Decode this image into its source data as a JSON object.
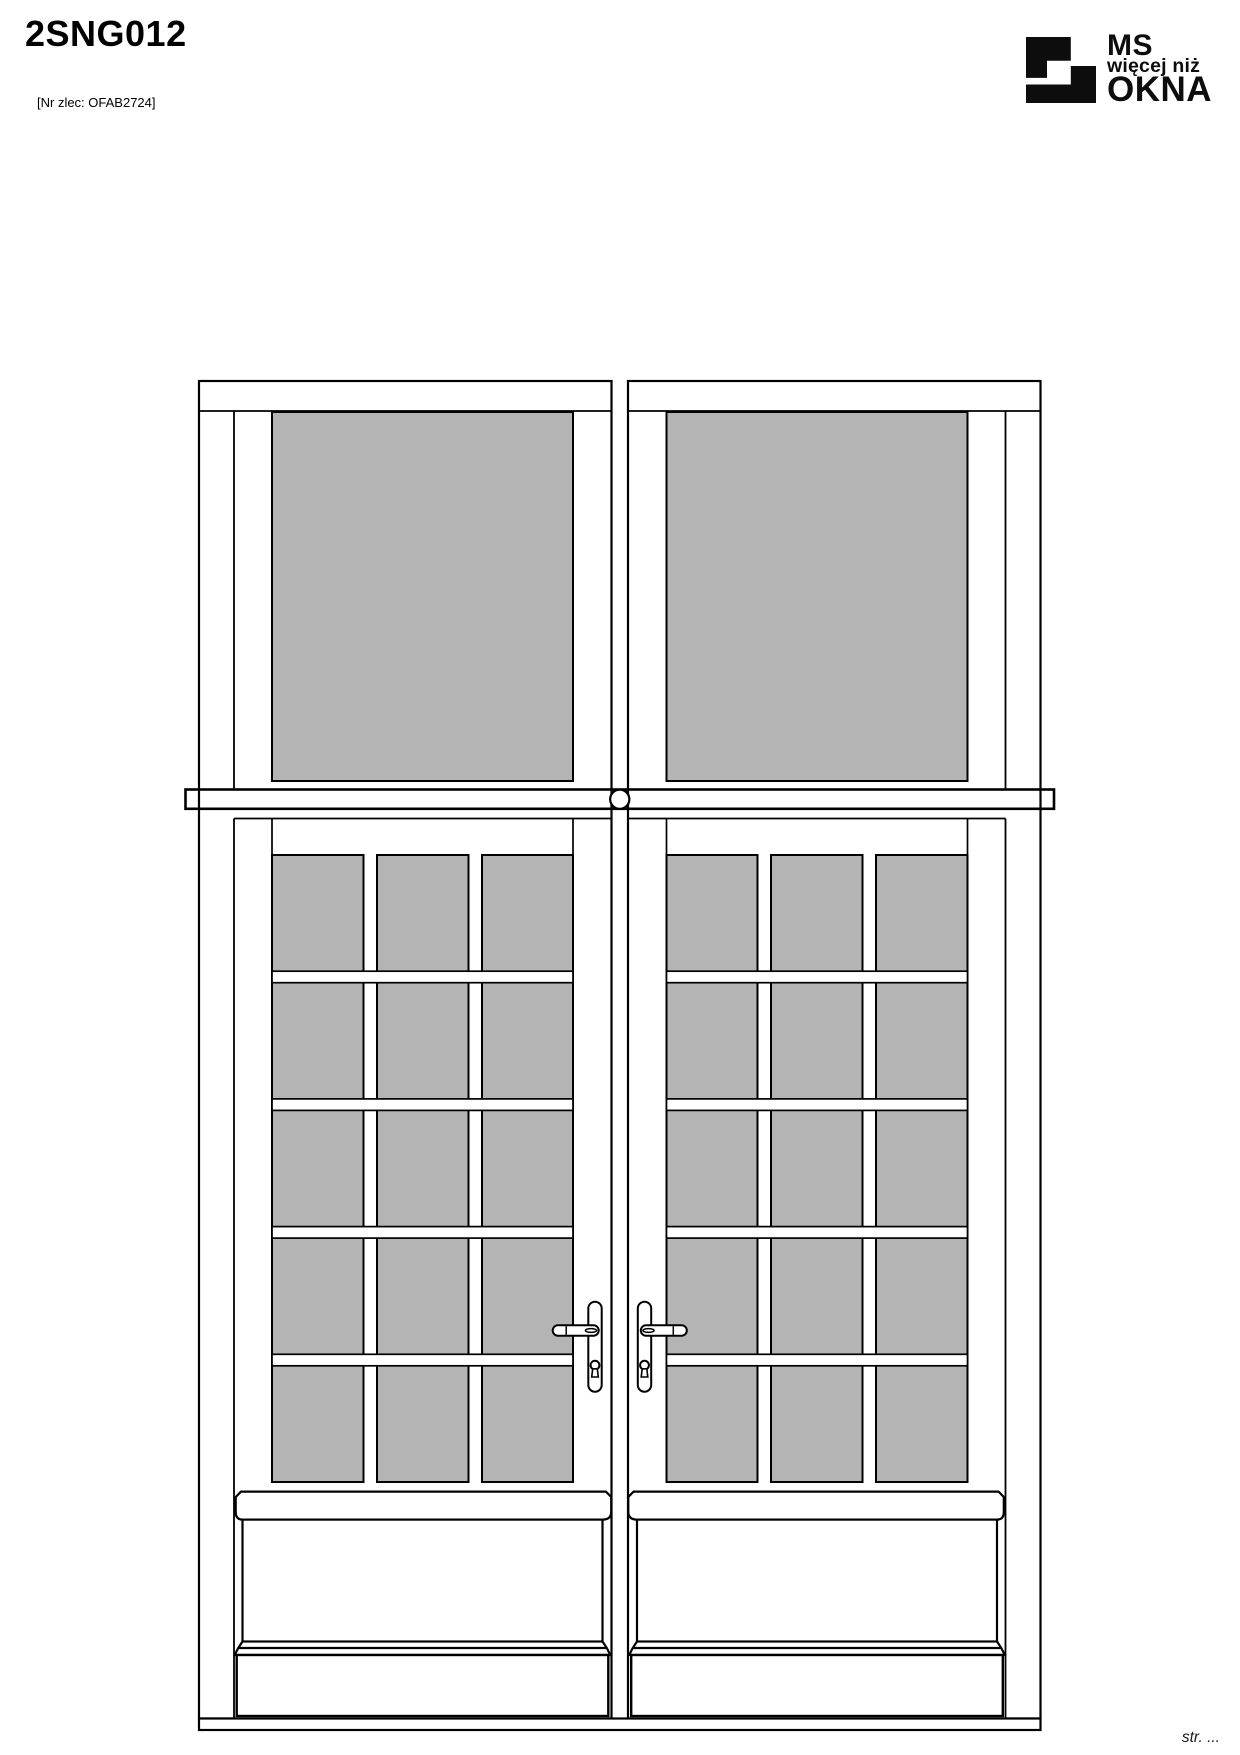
{
  "header": {
    "title": "2SNG012",
    "order_label": "[Nr zlec: OFAB2724]"
  },
  "logo": {
    "line1": "MS",
    "line2": "więcej niż",
    "line3": "OKNA",
    "color": "#0d0d0d"
  },
  "footer": {
    "page_label": "str. ..."
  },
  "drawing": {
    "glass_color": "#b4b4b4",
    "line_color": "#000000",
    "background": "#ffffff",
    "transom_panes": 2,
    "door_leaves": 2,
    "door_grid": {
      "columns": 3,
      "rows": 5
    },
    "handles": 2
  }
}
